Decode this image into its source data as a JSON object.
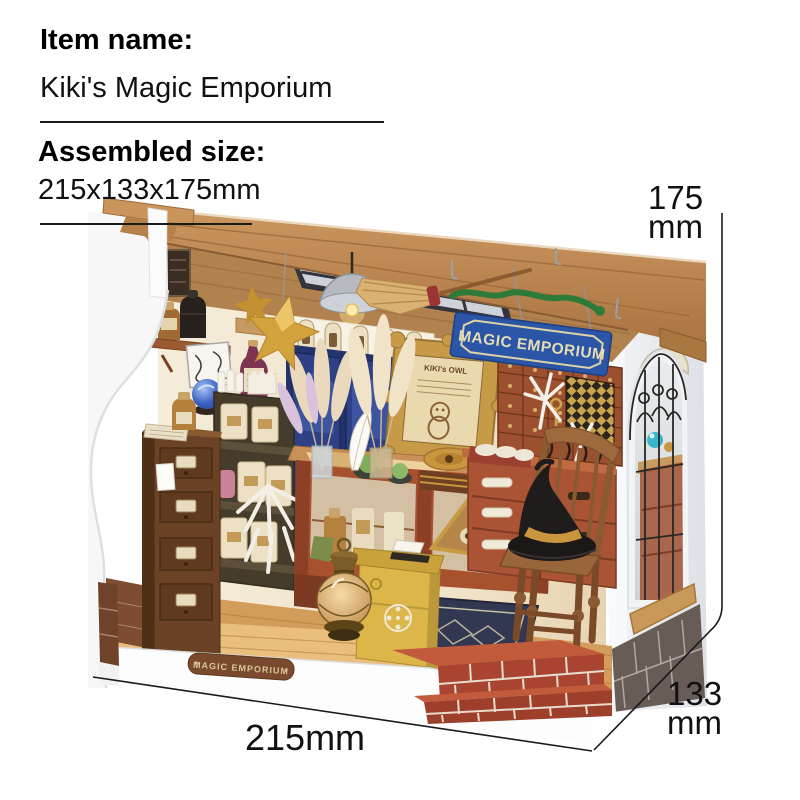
{
  "header": {
    "item_name_label": "Item name:",
    "item_name": "Kiki's Magic Emporium",
    "assembled_size_label": "Assembled size:",
    "assembled_size_value": "215x133x175mm"
  },
  "dimensions": {
    "height_value": "175",
    "height_unit": "mm",
    "width_value": "215mm",
    "depth_value": "133",
    "depth_unit": "mm"
  },
  "model": {
    "sign_text": "MAGIC EMPORIUM",
    "frame_title": "KIKI's OWL",
    "base_plate_text": "MAGIC EMPORIUM"
  },
  "palette": {
    "background": "#ffffff",
    "text": "#111111",
    "dimension_line": "#1a1a1a",
    "roof_wood": "#c08a54",
    "wall_cream": "#f2e8d4",
    "door_blue": "#2d3e7c",
    "sign_blue": "#2b55a6",
    "sign_cream": "#e6dcb4",
    "rust_cabinet": "#aa5435",
    "ornate_gold": "#c79a48",
    "floor_wood": "#d29c5a",
    "brick_red": "#a84430",
    "mailbox_yellow": "#dcb648",
    "witch_hat_black": "#1b1817",
    "exterior_white": "#f6f6f7"
  }
}
